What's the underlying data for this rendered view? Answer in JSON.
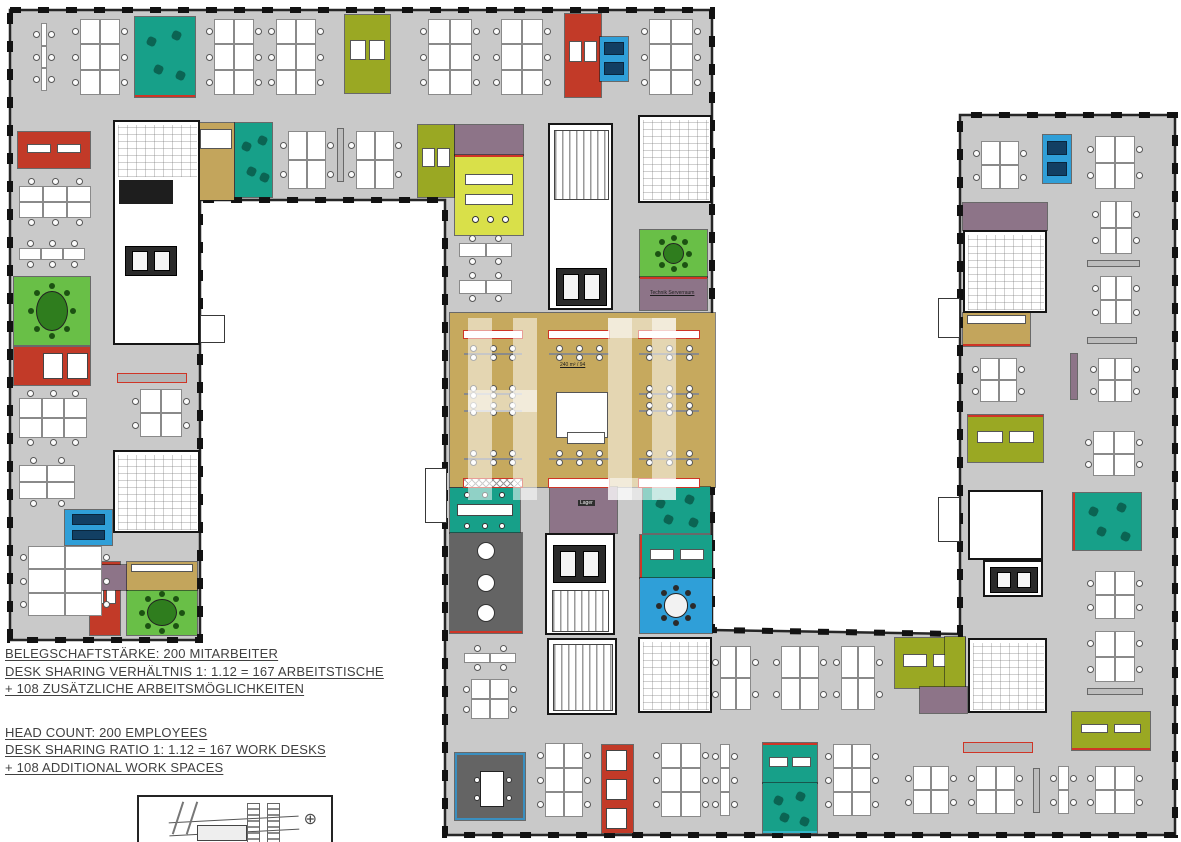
{
  "legend": {
    "de": [
      "BELEGSCHAFTSTÄRKE: 200 MITARBEITER",
      "DESK SHARING VERHÄLTNIS 1: 1.12  = 167 ARBEITSTISCHE",
      "+ 108 ZUSÄTZLICHE ARBEITSMÖGLICHKEITEN"
    ],
    "en": [
      "HEAD COUNT: 200 EMPLOYEES",
      "DESK SHARING RATIO 1: 1.12  = 167 WORK DESKS",
      "+ 108 ADDITIONAL WORK SPACES"
    ]
  },
  "inset": {
    "compass": "⊕"
  },
  "plan": {
    "palette": {
      "floor": "#c9c9c9",
      "wall": "#1b1b1b",
      "teal": "#17a089",
      "green": "#69bf47",
      "olive": "#9aa823",
      "chartreuse": "#d9e049",
      "red": "#c23a28",
      "blue": "#2f9fd8",
      "mauve": "#8d7488",
      "tan": "#c3a55c",
      "cafe": "#c6a95e",
      "dark": "#646464",
      "accent_red": "#cf3526",
      "accent_cyan": "#35b6c9",
      "accent_blue": "#3a8fc0",
      "table_green": "#2f7d1e",
      "booth_navy": "#123f63"
    },
    "footprint": "10,10 712,10 712,630 960,634 960,115 1175,115 1175,835 445,835 445,200 200,200 200,640 10,640",
    "rooms": [
      {
        "x": 450,
        "y": 313,
        "w": 265,
        "h": 174,
        "c": "cafe",
        "n": "cafeteria"
      },
      {
        "x": 135,
        "y": 17,
        "w": 60,
        "h": 80,
        "c": "teal",
        "f": "scatter",
        "acc": "b",
        "n": "lounge-room"
      },
      {
        "x": 235,
        "y": 123,
        "w": 37,
        "h": 74,
        "c": "teal",
        "f": "scatter",
        "n": "lounge-room"
      },
      {
        "x": 450,
        "y": 488,
        "w": 70,
        "h": 45,
        "c": "teal",
        "f": "longtable",
        "n": "lounge-room"
      },
      {
        "x": 643,
        "y": 487,
        "w": 67,
        "h": 46,
        "c": "teal",
        "f": "scatter",
        "n": "lounge-room"
      },
      {
        "x": 640,
        "y": 535,
        "w": 72,
        "h": 43,
        "c": "teal",
        "f": "desks",
        "acc": "l",
        "n": "media-room"
      },
      {
        "x": 763,
        "y": 743,
        "w": 54,
        "h": 40,
        "c": "teal",
        "f": "desks",
        "acc": "t",
        "n": "focus-room"
      },
      {
        "x": 763,
        "y": 783,
        "w": 54,
        "h": 50,
        "c": "teal",
        "f": "scatter",
        "acc": "b",
        "ac": "accent_cyan",
        "n": "lounge-room"
      },
      {
        "x": 1073,
        "y": 493,
        "w": 68,
        "h": 57,
        "c": "teal",
        "f": "scatter",
        "acc": "l",
        "n": "lounge-room"
      },
      {
        "x": 14,
        "y": 277,
        "w": 76,
        "h": 68,
        "c": "green",
        "f": "oval",
        "n": "meeting-room"
      },
      {
        "x": 640,
        "y": 230,
        "w": 67,
        "h": 47,
        "c": "green",
        "f": "round",
        "n": "meeting-room"
      },
      {
        "x": 127,
        "y": 590,
        "w": 70,
        "h": 45,
        "c": "green",
        "f": "oval",
        "n": "meeting-room"
      },
      {
        "x": 345,
        "y": 15,
        "w": 45,
        "h": 78,
        "c": "olive",
        "f": "desks",
        "n": "office-room"
      },
      {
        "x": 418,
        "y": 125,
        "w": 36,
        "h": 72,
        "c": "olive",
        "f": "desks",
        "n": "office-room"
      },
      {
        "x": 895,
        "y": 638,
        "w": 70,
        "h": 50,
        "c": "olive",
        "f": "desks",
        "n": "office-room"
      },
      {
        "x": 968,
        "y": 415,
        "w": 75,
        "h": 47,
        "c": "olive",
        "f": "desks",
        "acc": "t",
        "n": "office-room"
      },
      {
        "x": 1072,
        "y": 712,
        "w": 78,
        "h": 38,
        "c": "olive",
        "f": "desks",
        "acc": "b",
        "n": "office-room"
      },
      {
        "x": 945,
        "y": 637,
        "w": 20,
        "h": 58,
        "c": "olive",
        "n": "office-room"
      },
      {
        "x": 455,
        "y": 125,
        "w": 68,
        "h": 30,
        "c": "mauve",
        "n": "storage-room"
      },
      {
        "x": 455,
        "y": 155,
        "w": 68,
        "h": 80,
        "c": "chartreuse",
        "f": "tables",
        "acc": "t",
        "n": "project-room"
      },
      {
        "x": 565,
        "y": 14,
        "w": 36,
        "h": 83,
        "c": "red",
        "f": "desks",
        "n": "focus-room"
      },
      {
        "x": 18,
        "y": 132,
        "w": 72,
        "h": 36,
        "c": "red",
        "f": "desks",
        "n": "focus-room"
      },
      {
        "x": 14,
        "y": 347,
        "w": 76,
        "h": 38,
        "c": "red",
        "f": "booths2",
        "n": "phone-booths"
      },
      {
        "x": 90,
        "y": 562,
        "w": 30,
        "h": 73,
        "c": "red",
        "f": "desks",
        "n": "focus-room"
      },
      {
        "x": 602,
        "y": 745,
        "w": 31,
        "h": 88,
        "c": "red",
        "f": "booths3",
        "n": "phone-booths"
      },
      {
        "x": 600,
        "y": 37,
        "w": 28,
        "h": 44,
        "c": "blue",
        "f": "booth",
        "n": "phone-booth"
      },
      {
        "x": 1043,
        "y": 135,
        "w": 28,
        "h": 48,
        "c": "blue",
        "f": "booth",
        "n": "phone-booth"
      },
      {
        "x": 65,
        "y": 510,
        "w": 47,
        "h": 35,
        "c": "blue",
        "f": "booth",
        "n": "phone-booth"
      },
      {
        "x": 640,
        "y": 578,
        "w": 72,
        "h": 55,
        "c": "blue",
        "f": "round",
        "n": "meeting-room"
      },
      {
        "x": 640,
        "y": 277,
        "w": 67,
        "h": 33,
        "c": "mauve",
        "f": "ltech",
        "acc": "t",
        "n": "server-room"
      },
      {
        "x": 550,
        "y": 487,
        "w": 67,
        "h": 46,
        "c": "mauve",
        "f": "llager",
        "n": "storage-room"
      },
      {
        "x": 963,
        "y": 203,
        "w": 84,
        "h": 27,
        "c": "mauve",
        "n": "storage-room"
      },
      {
        "x": 920,
        "y": 687,
        "w": 47,
        "h": 26,
        "c": "mauve",
        "n": "storage-room"
      },
      {
        "x": 100,
        "y": 565,
        "w": 27,
        "h": 25,
        "c": "mauve",
        "n": "storage-room"
      },
      {
        "x": 198,
        "y": 123,
        "w": 36,
        "h": 77,
        "c": "tan",
        "f": "kitchen2",
        "n": "kitchenette"
      },
      {
        "x": 963,
        "y": 313,
        "w": 67,
        "h": 33,
        "c": "tan",
        "f": "kitchen2",
        "acc": "b",
        "n": "kitchenette"
      },
      {
        "x": 127,
        "y": 562,
        "w": 70,
        "h": 28,
        "c": "tan",
        "f": "kitchen2",
        "n": "kitchenette"
      },
      {
        "x": 450,
        "y": 533,
        "w": 72,
        "h": 100,
        "c": "dark",
        "f": "rounds",
        "acc": "b",
        "n": "workshop-room"
      },
      {
        "x": 455,
        "y": 753,
        "w": 70,
        "h": 67,
        "c": "dark",
        "f": "table",
        "acc": "a",
        "ac": "accent_blue",
        "n": "meeting-room-dark"
      }
    ],
    "cores": [
      {
        "x": 113,
        "y": 120,
        "w": 87,
        "h": 225,
        "n": "core-stairs-wc",
        "subs": [
          {
            "dx": 3,
            "dy": 3,
            "w": 79,
            "h": 52,
            "k": "wc"
          },
          {
            "dx": 4,
            "dy": 58,
            "w": 54,
            "h": 24,
            "k": "dark"
          },
          {
            "dx": 10,
            "dy": 124,
            "w": 52,
            "h": 30,
            "k": "elev"
          }
        ]
      },
      {
        "x": 548,
        "y": 123,
        "w": 65,
        "h": 187,
        "n": "core-stairs-elevators",
        "subs": [
          {
            "dx": 4,
            "dy": 5,
            "w": 55,
            "h": 70,
            "k": "stair"
          },
          {
            "dx": 6,
            "dy": 143,
            "w": 51,
            "h": 38,
            "k": "elev"
          }
        ]
      },
      {
        "x": 638,
        "y": 115,
        "w": 74,
        "h": 88,
        "n": "core-wc",
        "subs": [
          {
            "dx": 3,
            "dy": 3,
            "w": 66,
            "h": 80,
            "k": "wc"
          }
        ]
      },
      {
        "x": 113,
        "y": 450,
        "w": 87,
        "h": 83,
        "n": "core-wc",
        "subs": [
          {
            "dx": 3,
            "dy": 3,
            "w": 79,
            "h": 75,
            "k": "wc"
          }
        ]
      },
      {
        "x": 545,
        "y": 533,
        "w": 70,
        "h": 102,
        "n": "core-stairs-elevators",
        "subs": [
          {
            "dx": 6,
            "dy": 10,
            "w": 53,
            "h": 38,
            "k": "elev"
          },
          {
            "dx": 5,
            "dy": 55,
            "w": 57,
            "h": 42,
            "k": "stair"
          }
        ]
      },
      {
        "x": 547,
        "y": 638,
        "w": 70,
        "h": 77,
        "n": "core-stairs",
        "subs": [
          {
            "dx": 4,
            "dy": 4,
            "w": 60,
            "h": 67,
            "k": "stair"
          }
        ]
      },
      {
        "x": 638,
        "y": 637,
        "w": 74,
        "h": 76,
        "n": "core-wc",
        "subs": [
          {
            "dx": 3,
            "dy": 3,
            "w": 66,
            "h": 68,
            "k": "wc"
          }
        ]
      },
      {
        "x": 968,
        "y": 638,
        "w": 79,
        "h": 75,
        "n": "core-wc",
        "subs": [
          {
            "dx": 3,
            "dy": 3,
            "w": 71,
            "h": 67,
            "k": "wc"
          }
        ]
      },
      {
        "x": 963,
        "y": 230,
        "w": 84,
        "h": 83,
        "n": "core-wc",
        "subs": [
          {
            "dx": 3,
            "dy": 3,
            "w": 76,
            "h": 75,
            "k": "wc"
          }
        ]
      },
      {
        "x": 968,
        "y": 490,
        "w": 75,
        "h": 70,
        "n": "core-lobby",
        "subs": []
      },
      {
        "x": 983,
        "y": 560,
        "w": 60,
        "h": 37,
        "n": "core-elevators",
        "subs": [
          {
            "dx": 5,
            "dy": 5,
            "w": 48,
            "h": 26,
            "k": "elev"
          }
        ]
      }
    ],
    "clusters": [
      [
        33,
        22,
        22,
        70,
        "s3"
      ],
      [
        72,
        18,
        56,
        78,
        "v6"
      ],
      [
        206,
        18,
        56,
        78,
        "v6"
      ],
      [
        268,
        18,
        56,
        78,
        "v6"
      ],
      [
        420,
        18,
        60,
        78,
        "v6"
      ],
      [
        493,
        18,
        58,
        78,
        "v6"
      ],
      [
        641,
        18,
        60,
        78,
        "v6"
      ],
      [
        280,
        130,
        54,
        60,
        "v4"
      ],
      [
        348,
        130,
        54,
        60,
        "v4"
      ],
      [
        18,
        178,
        74,
        48,
        "h6"
      ],
      [
        18,
        240,
        68,
        28,
        "h3"
      ],
      [
        18,
        390,
        70,
        56,
        "h6"
      ],
      [
        132,
        388,
        58,
        50,
        "v4"
      ],
      [
        18,
        457,
        58,
        50,
        "h4"
      ],
      [
        20,
        545,
        90,
        72,
        "v6"
      ],
      [
        458,
        235,
        55,
        30,
        "b2"
      ],
      [
        458,
        272,
        55,
        30,
        "b2"
      ],
      [
        463,
        645,
        54,
        26,
        "b2"
      ],
      [
        463,
        678,
        54,
        42,
        "v4"
      ],
      [
        537,
        742,
        54,
        76,
        "v6"
      ],
      [
        653,
        742,
        56,
        76,
        "v6"
      ],
      [
        712,
        743,
        26,
        74,
        "s3"
      ],
      [
        825,
        743,
        54,
        74,
        "v6"
      ],
      [
        712,
        645,
        47,
        66,
        "v4"
      ],
      [
        773,
        645,
        54,
        66,
        "v4"
      ],
      [
        833,
        645,
        50,
        66,
        "v4"
      ],
      [
        905,
        765,
        52,
        50,
        "v4"
      ],
      [
        968,
        765,
        55,
        50,
        "v4"
      ],
      [
        1050,
        765,
        27,
        50,
        "s2"
      ],
      [
        1087,
        765,
        56,
        50,
        "v4"
      ],
      [
        973,
        140,
        54,
        50,
        "v4"
      ],
      [
        1087,
        135,
        56,
        55,
        "v4"
      ],
      [
        1092,
        200,
        48,
        55,
        "v4"
      ],
      [
        1092,
        275,
        48,
        50,
        "v4"
      ],
      [
        972,
        357,
        53,
        46,
        "v4"
      ],
      [
        1090,
        357,
        50,
        46,
        "v4"
      ],
      [
        1085,
        430,
        58,
        47,
        "v4"
      ],
      [
        1087,
        570,
        56,
        50,
        "v4"
      ],
      [
        1087,
        630,
        56,
        53,
        "v4"
      ],
      [
        463,
        345,
        60,
        16,
        "long"
      ],
      [
        548,
        345,
        62,
        16,
        "long"
      ],
      [
        638,
        345,
        62,
        16,
        "long"
      ],
      [
        463,
        385,
        60,
        14,
        "long"
      ],
      [
        463,
        402,
        60,
        14,
        "long"
      ],
      [
        638,
        385,
        62,
        14,
        "long"
      ],
      [
        638,
        402,
        62,
        14,
        "long"
      ],
      [
        463,
        450,
        60,
        16,
        "long"
      ],
      [
        548,
        450,
        62,
        16,
        "long"
      ],
      [
        638,
        450,
        62,
        16,
        "long"
      ]
    ],
    "counters": [
      [
        463,
        330,
        60,
        9,
        ""
      ],
      [
        548,
        330,
        62,
        9,
        ""
      ],
      [
        638,
        330,
        62,
        9,
        ""
      ],
      [
        548,
        478,
        62,
        10,
        ""
      ],
      [
        638,
        478,
        62,
        10,
        ""
      ],
      [
        463,
        478,
        60,
        10,
        "x"
      ]
    ],
    "cabinets": [
      [
        1087,
        260,
        53,
        7,
        ""
      ],
      [
        1087,
        337,
        50,
        7,
        ""
      ],
      [
        1087,
        688,
        56,
        7,
        ""
      ],
      [
        337,
        128,
        7,
        54,
        ""
      ],
      [
        1070,
        353,
        8,
        47,
        "m"
      ],
      [
        1033,
        768,
        7,
        45,
        ""
      ],
      [
        117,
        373,
        70,
        10,
        "r"
      ],
      [
        963,
        742,
        70,
        11,
        "r"
      ]
    ],
    "kitchen": {
      "x": 556,
      "y": 392,
      "w": 52,
      "h": 46,
      "island": [
        567,
        432,
        38,
        12
      ]
    },
    "watermark": [
      [
        468,
        318,
        24,
        182
      ],
      [
        513,
        318,
        24,
        182
      ],
      [
        468,
        390,
        69,
        22
      ],
      [
        608,
        318,
        24,
        182
      ],
      [
        652,
        318,
        24,
        182
      ],
      [
        608,
        318,
        68,
        20
      ],
      [
        608,
        478,
        68,
        22
      ]
    ],
    "balconies": [
      [
        200,
        315,
        25,
        28
      ],
      [
        938,
        298,
        22,
        40
      ],
      [
        938,
        497,
        22,
        45
      ],
      [
        425,
        468,
        22,
        55
      ]
    ],
    "labels": [
      {
        "t": "240 m² / 94",
        "x": 560,
        "y": 362,
        "s": "u"
      },
      {
        "t": "Technik Serverraum",
        "x": 650,
        "y": 290,
        "s": "u"
      },
      {
        "t": "Lager",
        "x": 578,
        "y": 500,
        "s": "chip"
      }
    ]
  }
}
